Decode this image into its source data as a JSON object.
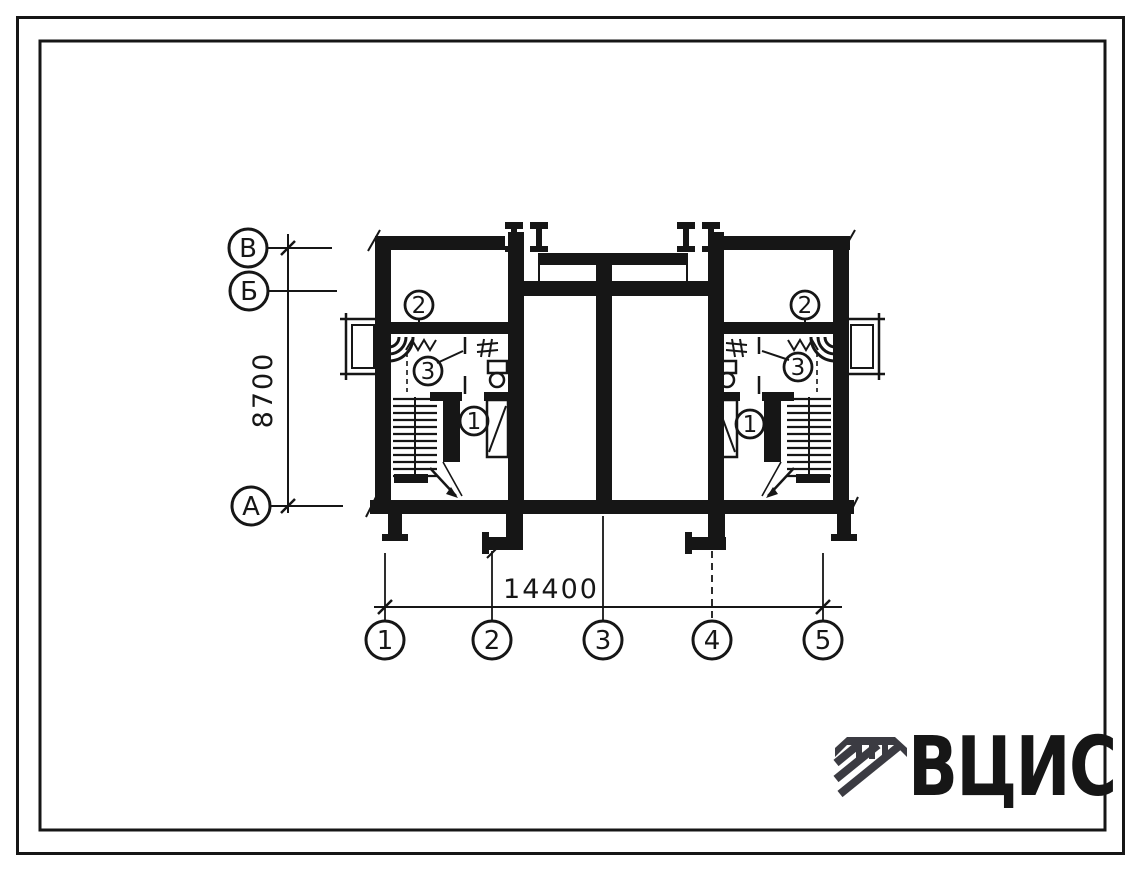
{
  "plan": {
    "side_axes": [
      {
        "label": "В"
      },
      {
        "label": "Б"
      },
      {
        "label": "А"
      }
    ],
    "bottom_axes": [
      {
        "label": "1"
      },
      {
        "label": "2"
      },
      {
        "label": "3"
      },
      {
        "label": "4"
      },
      {
        "label": "5"
      }
    ],
    "dim_vertical": "8700",
    "dim_horizontal": "14400",
    "rooms_left": [
      {
        "number": "2"
      },
      {
        "number": "3"
      },
      {
        "number": "1"
      }
    ],
    "rooms_right": [
      {
        "number": "2"
      },
      {
        "number": "3"
      },
      {
        "number": "1"
      }
    ]
  },
  "logo": {
    "text": "ВЦИС",
    "color": "#3b3b42"
  },
  "colors": {
    "ink": "#161616",
    "paper": "#ffffff"
  }
}
